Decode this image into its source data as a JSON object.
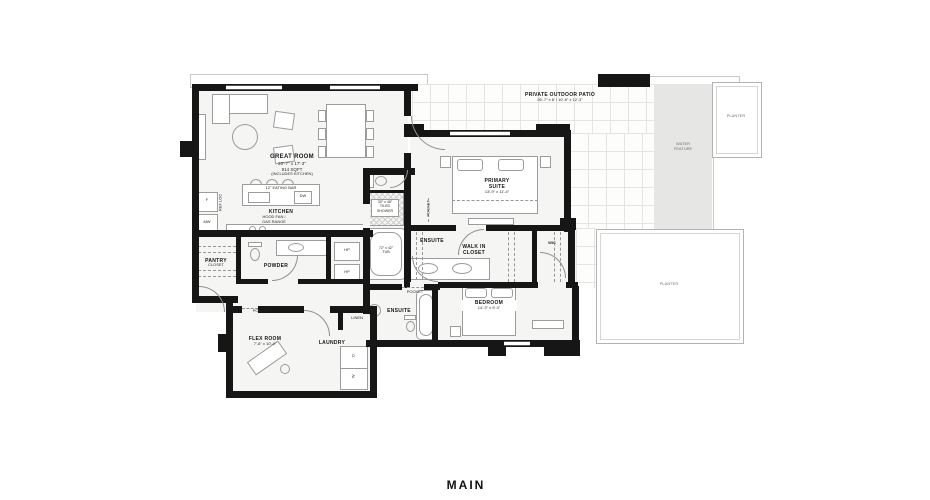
{
  "title": "MAIN",
  "colors": {
    "wall": "#161616",
    "room_fill": "#f5f5f3",
    "water_feature": "#e6e6e4",
    "patio_grid": "#e4e4e2"
  },
  "outdoor": {
    "patio_name": "PRIVATE OUTDOOR PATIO",
    "patio_dims": "26'-7\" x 8' / 10'-8\" x 12'-3\"",
    "water_feature_line1": "WATER",
    "water_feature_line2": "FEATURE",
    "planter_top": "PLANTER",
    "planter_bottom": "PLANTER"
  },
  "rooms": {
    "great_room": {
      "name": "GREAT ROOM",
      "dims": "20'-7\" x 17'-3\"",
      "area": "914 SQFT",
      "note": "(INCLUDES KITCHEN)"
    },
    "kitchen": {
      "name": "KITCHEN",
      "eating_bar": "12\" EATING BAR",
      "hood1": "HOOD FAN /",
      "hood2": "GAS RANGE",
      "dw": "DW",
      "fridge": "F",
      "microwave": "MW",
      "ref_loc": "REF LOC"
    },
    "pantry": {
      "name": "PANTRY"
    },
    "closet": {
      "name": "CLOSET"
    },
    "powder": {
      "name": "POWDER",
      "hp": "HP"
    },
    "flex_room": {
      "name": "FLEX ROOM",
      "dims": "7'-8\" x 10'-4\""
    },
    "laundry": {
      "name": "LAUNDRY",
      "linen": "LINEN",
      "dryer": "D",
      "washer": "W"
    },
    "ensuite_primary": {
      "name": "ENSUITE",
      "shower1": "30\" x 48\"",
      "shower2": "TILED",
      "shower3": "SHOWER",
      "tub1": "72\" x 42\"",
      "tub2": "TUB"
    },
    "primary_suite": {
      "name1": "PRIMARY",
      "name2": "SUITE",
      "dims": "13'-9\" x 11'-4\""
    },
    "walk_in_closet": {
      "name1": "WALK IN",
      "name2": "CLOSET"
    },
    "wic": {
      "name": "WIC"
    },
    "bedroom": {
      "name": "BEDROOM",
      "dims": "14'-3\" x 9'-3\""
    },
    "ensuite_second": {
      "name": "ENSUITE"
    }
  },
  "doors": {
    "pocket": "POCKET"
  }
}
